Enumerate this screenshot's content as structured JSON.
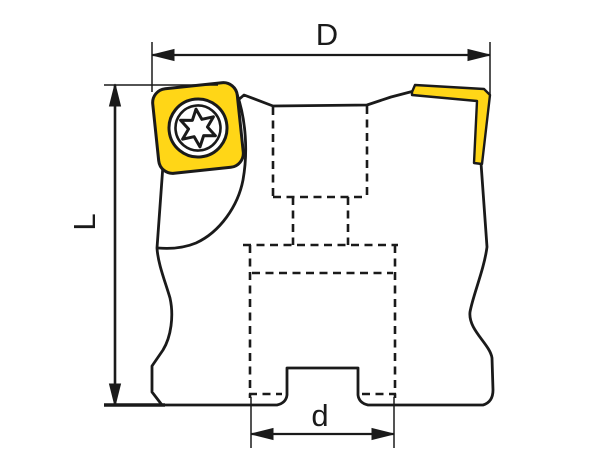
{
  "drawing": {
    "type": "technical-drawing",
    "subject": "face-milling-cutter-side-view",
    "dimensions": {
      "outer_diameter_label": "D",
      "length_label": "L",
      "bore_diameter_label": "d"
    },
    "icons": {
      "screw": "torx-screw-icon"
    },
    "colors": {
      "insert_highlight": "#FFD617",
      "line": "#1A1A1A",
      "background": "#FFFFFF"
    }
  }
}
